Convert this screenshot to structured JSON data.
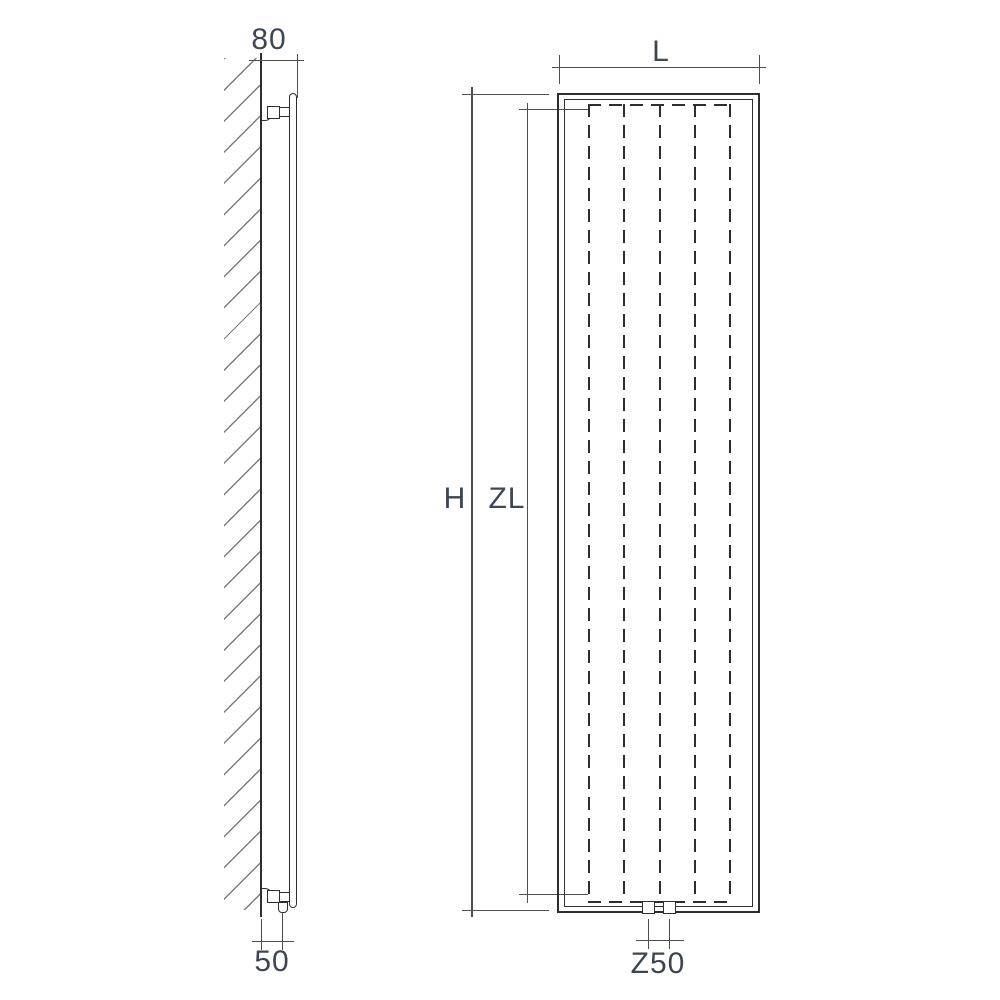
{
  "diagram": {
    "labels": {
      "side_depth": "80",
      "side_pipe_offset": "50",
      "front_width": "L",
      "front_height": "H",
      "front_inner_height": "ZL",
      "front_pipe_spacing": "Z50"
    },
    "colors": {
      "background": "#ffffff",
      "object_line": "#2e2e2e",
      "dimension_line": "#4f4f4f",
      "label_text": "#3e4654",
      "hatch": "#7c7c7c"
    }
  }
}
